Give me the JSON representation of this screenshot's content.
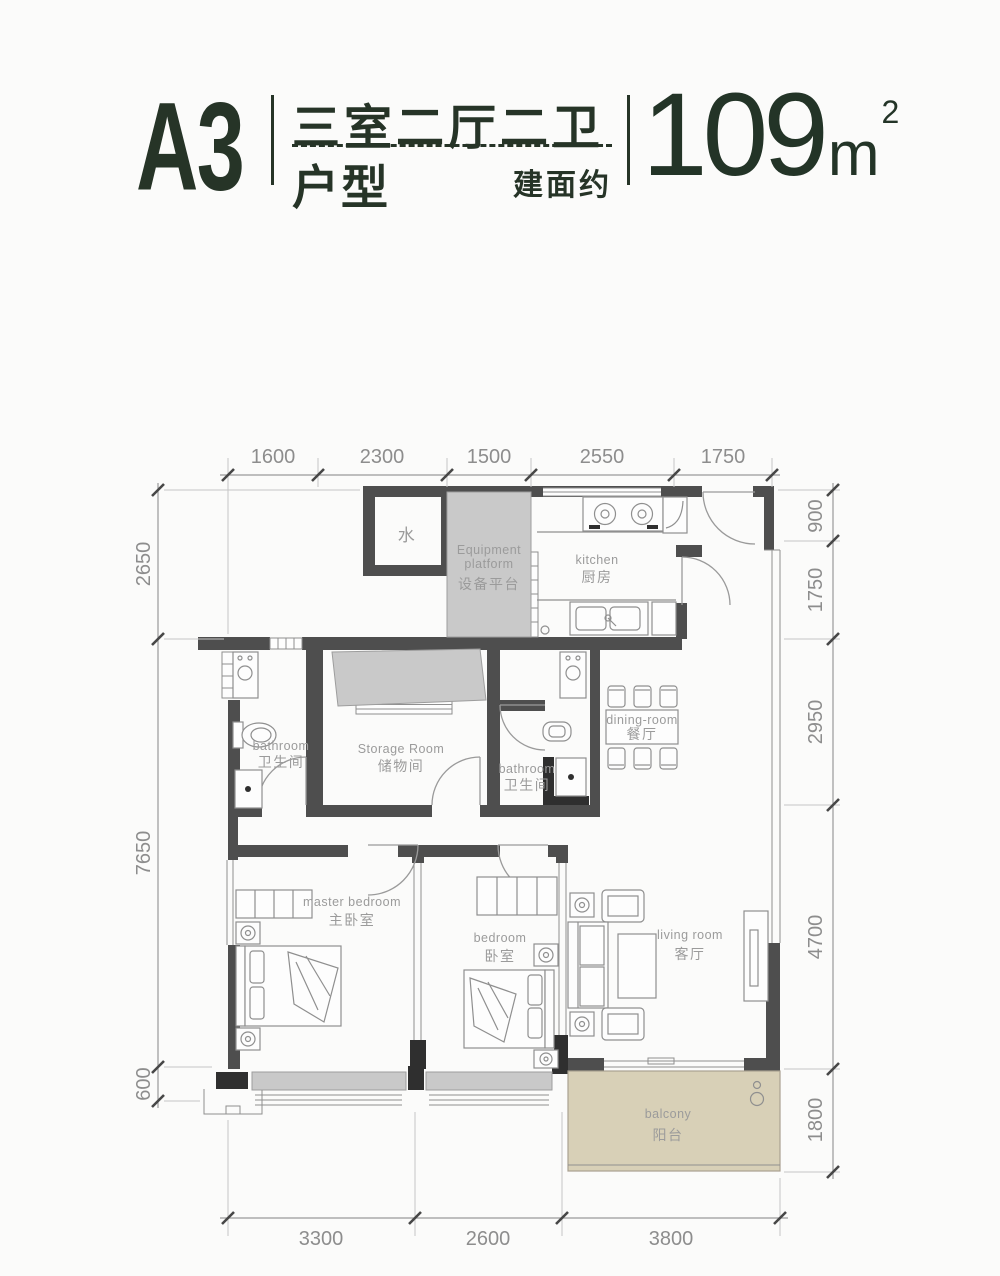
{
  "header": {
    "unit_code": "A3",
    "layout_title": "三室二厅二卫",
    "unit_type": "户型",
    "area_prefix": "建面约",
    "area_value": "109",
    "area_unit": "m",
    "area_sup": "2"
  },
  "colors": {
    "accent": "#263427",
    "wall": "#4e4e4e",
    "column": "#2f2f2f",
    "shade": "#c9c9c9",
    "balcony": "#d8d0b7",
    "dim_text": "#8d8d8d",
    "label_text": "#9b9b9b"
  },
  "plan": {
    "rooms": {
      "water": {
        "zh": "水"
      },
      "equipment": {
        "en1": "Equipment",
        "en2": "platform",
        "zh": "设备平台"
      },
      "kitchen": {
        "en": "kitchen",
        "zh": "厨房"
      },
      "bathroom_left": {
        "en": "bathroom",
        "zh": "卫生间"
      },
      "storage": {
        "en": "Storage Room",
        "zh": "储物间"
      },
      "bathroom_right": {
        "en": "bathroom",
        "zh": "卫生间"
      },
      "dining": {
        "en": "dining-room",
        "zh": "餐厅"
      },
      "master": {
        "en": "master bedroom",
        "zh": "主卧室"
      },
      "bedroom": {
        "en": "bedroom",
        "zh": "卧室"
      },
      "living": {
        "en": "living room",
        "zh": "客厅"
      },
      "balcony": {
        "en": "balcony",
        "zh": "阳台"
      }
    },
    "dims": {
      "top": [
        "1600",
        "2300",
        "1500",
        "2550",
        "1750"
      ],
      "left": [
        "2650",
        "7650",
        "600"
      ],
      "right": [
        "900",
        "1750",
        "2950",
        "4700",
        "1800"
      ],
      "bottom": [
        "3300",
        "2600",
        "3800"
      ]
    }
  }
}
